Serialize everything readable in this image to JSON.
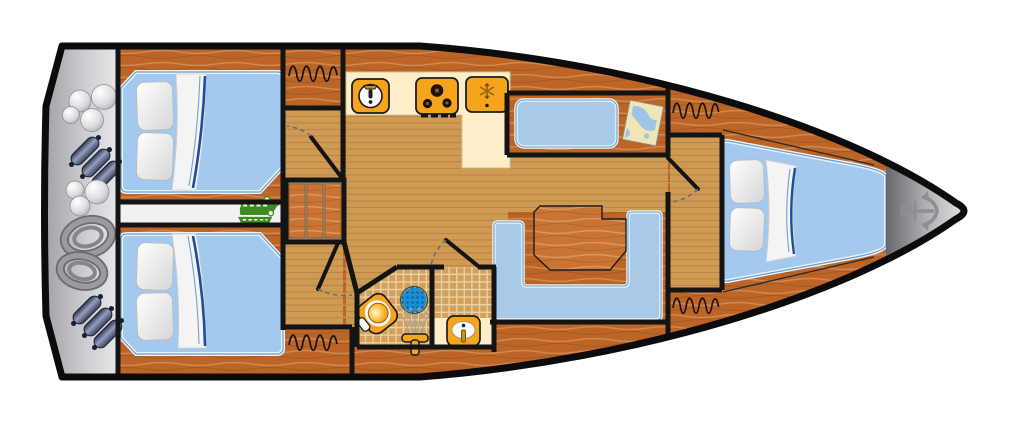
{
  "title": "sailing-yacht-floorplan",
  "colors": {
    "hull_outline": "#0c0c0c",
    "wall": "#141414",
    "door_arc": "#6e6e6e",
    "wood_dark": "#bc6526",
    "wood_light": "#c97434",
    "floor_tan": "#cf9b52",
    "floor_stripe": "#b9854a",
    "counter_cream": "#fdeec9",
    "appliance_orange": "#f6a41c",
    "berth_blue": "#a3c9ee",
    "sofa_blue": "#a9c9e9",
    "corridor_white": "#f1f1f1",
    "engine_green": "#3e8c1e",
    "tile_tan": "#d4a05e",
    "tile_line": "#ead1a2",
    "shower_blue": "#1b8fd1",
    "shower_ring": "#d9a440",
    "stern_gray": "#b9b9bd",
    "bow_gray": "#9a9a9e",
    "anchor_gray": "#8f8f93",
    "rope_gray": "#96969a",
    "fender_navy": "#4a5472",
    "chart_paper": "#f1e5b5",
    "chart_water": "#9ec4e8",
    "blanket_navy": "#1d4e9b",
    "pillow_white": "#f4f4f4"
  },
  "areas": [
    {
      "id": "stern-locker",
      "items": [
        "ball-fender",
        "cylindrical-fender",
        "mooring-rope-coils"
      ]
    },
    {
      "id": "aft-cabin-port",
      "items": [
        "double-berth",
        "pillows",
        "blanket"
      ]
    },
    {
      "id": "engine-compartment",
      "items": [
        "engine-icon"
      ]
    },
    {
      "id": "aft-cabin-starboard",
      "items": [
        "double-berth",
        "pillows",
        "blanket"
      ]
    },
    {
      "id": "companionway",
      "items": [
        "stairs"
      ]
    },
    {
      "id": "galley",
      "items": [
        "sink-icon",
        "stove-3-burner-icon",
        "refrigerator-snowflake-icon",
        "counter"
      ]
    },
    {
      "id": "salon",
      "items": [
        "settee-bench",
        "nav-table",
        "sea-chart",
        "u-shaped-sofa",
        "dining-table"
      ]
    },
    {
      "id": "head",
      "items": [
        "toilet-icon",
        "shower-drain-icon",
        "shower-tap-icon",
        "washbasin-icon"
      ]
    },
    {
      "id": "forward-cabin",
      "items": [
        "v-berth",
        "pillows",
        "blanket"
      ]
    },
    {
      "id": "bow-locker",
      "items": [
        "anchor-icon"
      ]
    }
  ],
  "counts": {
    "cabins": 3,
    "berths": 3,
    "hatches": 4,
    "interior_doors": 4,
    "pillows": 6
  }
}
